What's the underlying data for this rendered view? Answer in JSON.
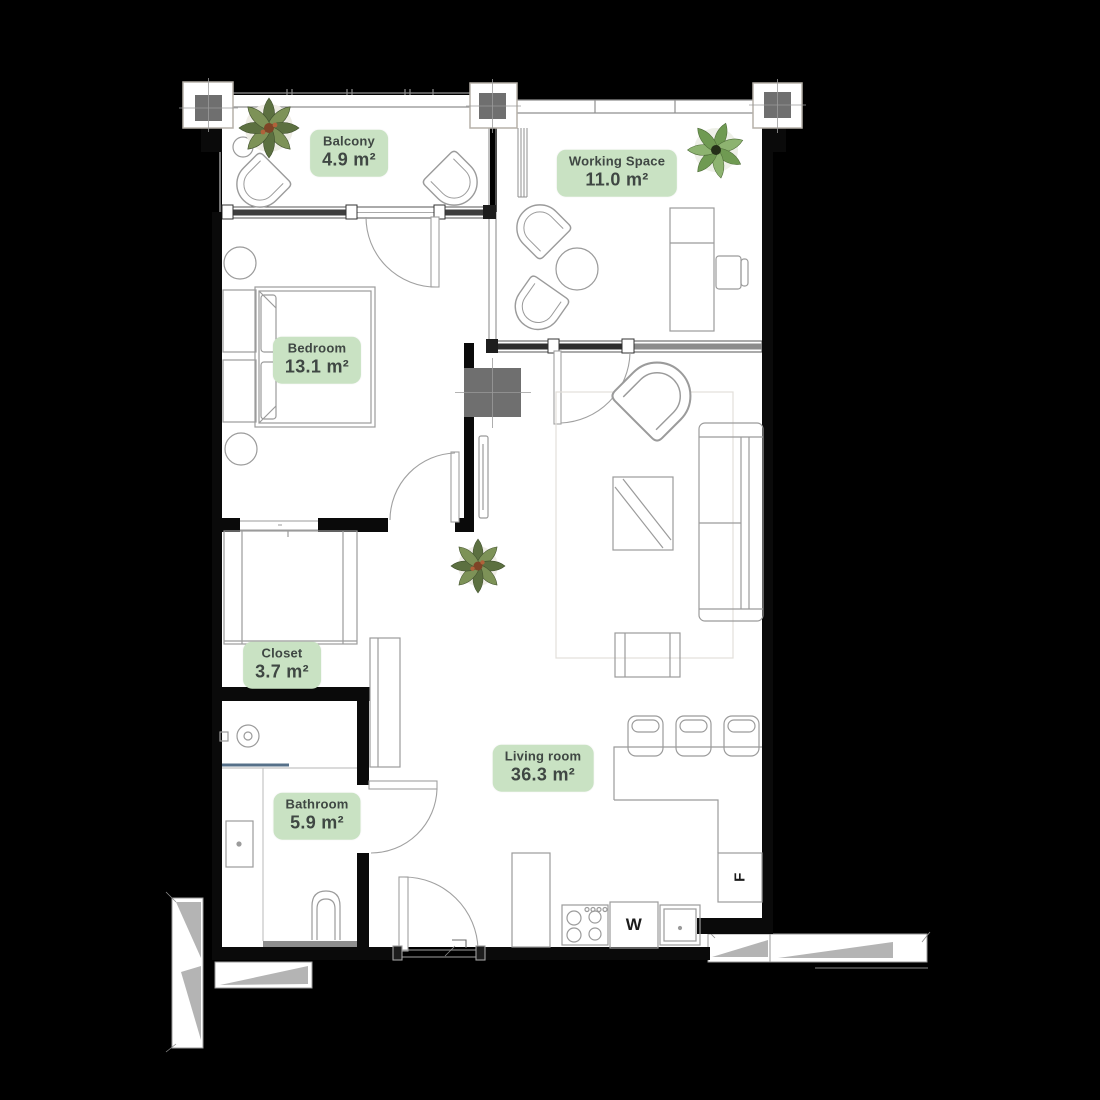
{
  "plan": {
    "type": "apartment-floor-plan",
    "rooms": [
      {
        "id": "balcony",
        "name": "Balcony",
        "area": "4.9 m²"
      },
      {
        "id": "working-space",
        "name": "Working Space",
        "area": "11.0 m²"
      },
      {
        "id": "bedroom",
        "name": "Bedroom",
        "area": "13.1 m²"
      },
      {
        "id": "closet",
        "name": "Closet",
        "area": "3.7 m²"
      },
      {
        "id": "bathroom",
        "name": "Bathroom",
        "area": "5.9 m²"
      },
      {
        "id": "living-room",
        "name": "Living room",
        "area": "36.3 m²"
      }
    ],
    "appliances": {
      "washer_label": "W",
      "fridge_label": "F"
    }
  },
  "colors": {
    "background": "#000000",
    "floor": "#ffffff",
    "wall": "#0a0a0a",
    "badge_bg": "#c9e2c3",
    "badge_text": "#3f4743",
    "column_fill": "#6f6f6f",
    "window_dark": "#3e3e3e",
    "window_glass": "#8c8c8c",
    "furniture_line": "#9b9b9b",
    "plant_leaf_dark": "#5c7040",
    "plant_leaf_light": "#7d9257",
    "shower_glass": "#567089",
    "shadow_gray": "#b4b4b4"
  }
}
